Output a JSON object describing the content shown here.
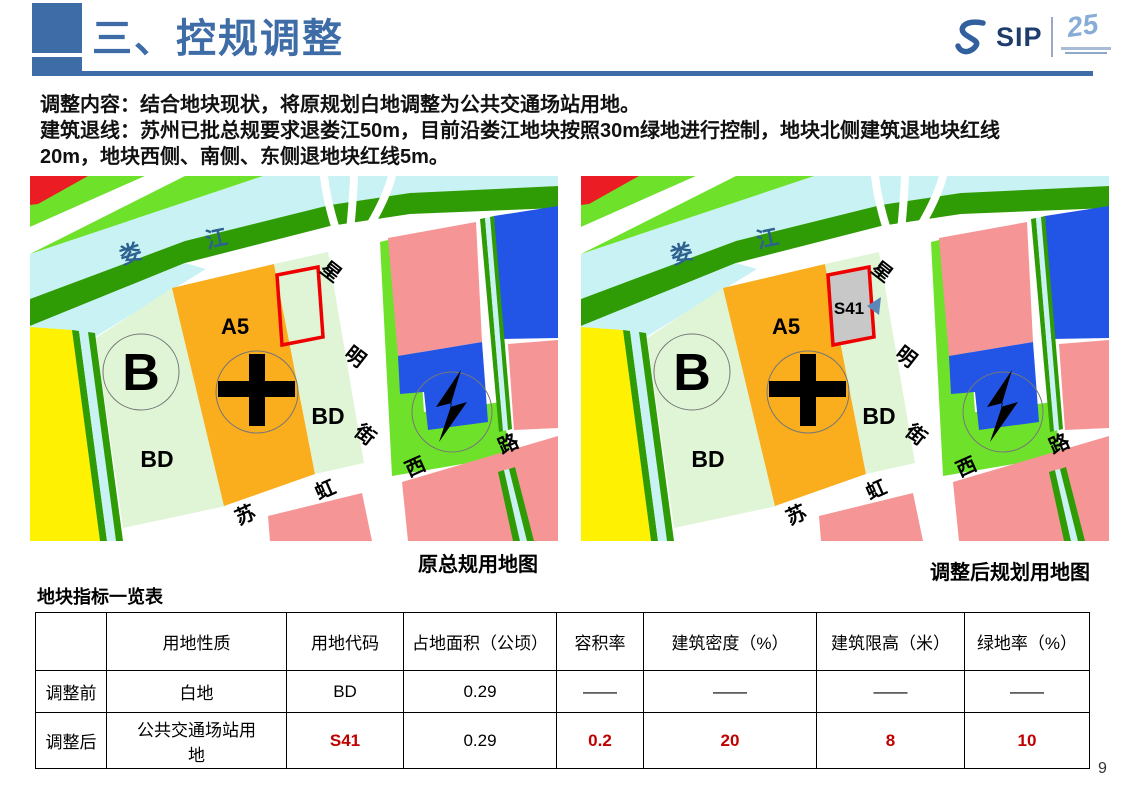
{
  "header": {
    "title": "三、控规调整",
    "logo": {
      "sip": "SIP",
      "anniversary": "25"
    }
  },
  "intro": {
    "line1": "调整内容：结合地块现状，将原规划白地调整为公共交通场站用地。",
    "line2": "建筑退线：苏州已批总规要求退娄江50m，目前沿娄江地块按照30m绿地进行控制，地块北侧建筑退地块红线20m，地块西侧、南侧、东侧退地块红线5m。"
  },
  "maps": {
    "left_caption": "原总规用地图",
    "right_caption": "调整后规划用地图",
    "labels": {
      "river": [
        "娄",
        "江"
      ],
      "street_xingming": [
        "星",
        "明",
        "街"
      ],
      "street_suhong": [
        "苏",
        "虹",
        "西",
        "路"
      ],
      "parcel_b": "B",
      "parcel_bd": "BD",
      "parcel_a5": "A5",
      "parcel_s41": "S41"
    },
    "colors": {
      "river": "#C9F2F4",
      "green_belt": "#2F9C06",
      "bright_green": "#6EE22A",
      "pale_green": "#DFF5D6",
      "orange": "#FAAD1D",
      "yellow": "#FEF102",
      "pink": "#F59596",
      "blue": "#2255E5",
      "red": "#EC1C24",
      "gray_parcel": "#C8C8C8",
      "outline_red": "#EE0000",
      "river_text": "#2D618F",
      "marker_blue": "#5A86B8"
    }
  },
  "table": {
    "title": "地块指标一览表",
    "headers": [
      "",
      "用地性质",
      "用地代码",
      "占地面积（公顷）",
      "容积率",
      "建筑密度（%）",
      "建筑限高（米）",
      "绿地率（%）"
    ],
    "rows": [
      {
        "label": "调整前",
        "cells": [
          "白地",
          "BD",
          "0.29",
          "——",
          "——",
          "——",
          "——"
        ]
      },
      {
        "label": "调整后",
        "cells": [
          "公共交通场站用地",
          "S41",
          "0.29",
          "0.2",
          "20",
          "8",
          "10"
        ]
      }
    ]
  },
  "page_number": "9"
}
